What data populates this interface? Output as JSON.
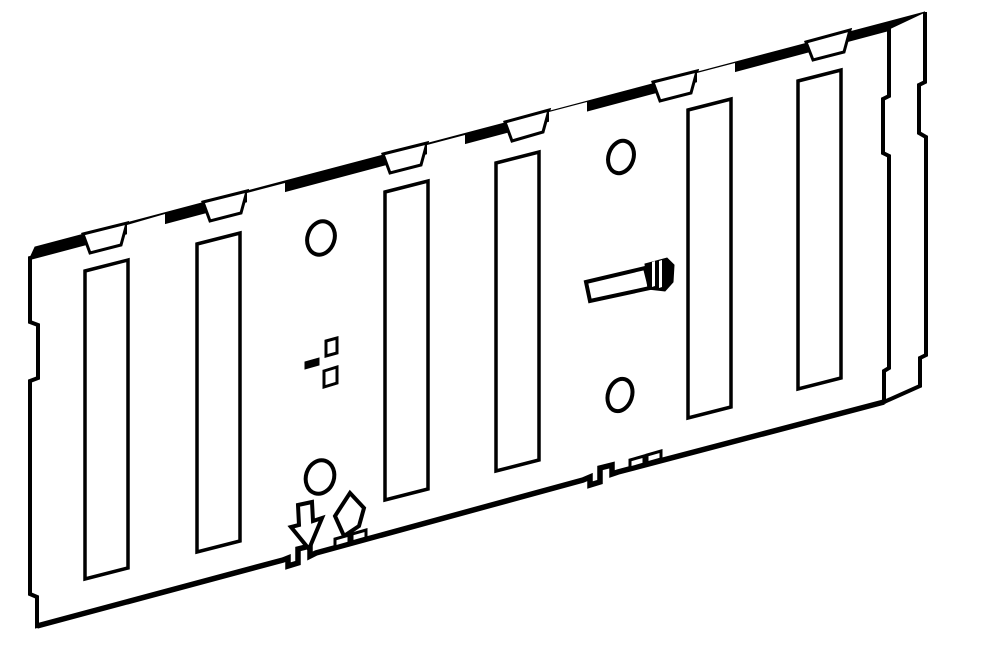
{
  "meta": {
    "title": "Isometric line diagram of a sheet-metal backplane plate with six slots, round holes, bent locating tab, and alignment arrow and diamond marks",
    "background_color": "#ffffff",
    "line_color": "#000000"
  },
  "canvas": {
    "width": 1000,
    "height": 651
  },
  "diagram": {
    "shapes": [
      {
        "name": "plate-front-face",
        "type": "path",
        "fill": "#ffffff",
        "sw": 4,
        "d": "M30,258 L889,29 L889,96 L883,99 L883,153 L889,156 L889,368 L884,371 L884,402 L618,472 L612,474 L612,465 L600,468 L600,482 L590,485 L590,477 L583,480 L316,553 L310,556 L310,546 L298,549 L298,563 L288,566 L288,558 L283,560 L37,626 L37,597 L30,594 L30,381 L38,378 L38,325 L30,322 Z"
      },
      {
        "name": "plate-bottom-edge",
        "type": "polyline",
        "fill": "none",
        "sw": 5.5,
        "points": "884,402 618,472 612,474 612,465 600,468 600,482 590,485 590,477 583,480 316,553 310,556 310,546 298,549 298,563 288,566 288,558 283,560 37,626"
      },
      {
        "name": "top-edge-band",
        "type": "polygon",
        "fill": "#000000",
        "sw": 1,
        "points": "30,258 889,29 925,12 35,247"
      },
      {
        "name": "top-tab-pocket-1",
        "type": "polygon",
        "fill": "#ffffff",
        "sw": 3,
        "points": "83,234 127,223 121,245 90,253"
      },
      {
        "name": "top-tab-pocket-2",
        "type": "polygon",
        "fill": "#ffffff",
        "sw": 3,
        "points": "203,202 247,191 241,213 210,221"
      },
      {
        "name": "top-tab-pocket-3",
        "type": "polygon",
        "fill": "#ffffff",
        "sw": 3,
        "points": "383,154 427,143 421,165 390,173"
      },
      {
        "name": "top-tab-pocket-4",
        "type": "polygon",
        "fill": "#ffffff",
        "sw": 3,
        "points": "505,122 549,110 543,132 512,141"
      },
      {
        "name": "top-tab-pocket-5",
        "type": "polygon",
        "fill": "#ffffff",
        "sw": 3,
        "points": "653,82 697,71 691,93 660,101"
      },
      {
        "name": "top-tab-pocket-6",
        "type": "polygon",
        "fill": "#ffffff",
        "sw": 3,
        "points": "806,42 850,30 844,52 813,60"
      },
      {
        "name": "band-step-slice-1",
        "type": "polygon",
        "fill": "#ffffff",
        "sw": 0,
        "points": "127,225 165,214 165,225 127,235"
      },
      {
        "name": "band-step-slice-2",
        "type": "polygon",
        "fill": "#ffffff",
        "sw": 0,
        "points": "247,193 285,183 285,193 247,203"
      },
      {
        "name": "band-step-slice-3",
        "type": "polygon",
        "fill": "#ffffff",
        "sw": 0,
        "points": "427,145 465,135 465,145 427,155"
      },
      {
        "name": "band-step-slice-4",
        "type": "polygon",
        "fill": "#ffffff",
        "sw": 0,
        "points": "549,112 587,102 587,113 549,123"
      },
      {
        "name": "band-step-slice-5",
        "type": "polygon",
        "fill": "#ffffff",
        "sw": 0,
        "points": "697,73 735,63 735,73 697,83"
      },
      {
        "name": "plate-right-back-edge",
        "type": "polyline",
        "fill": "none",
        "sw": 4,
        "points": "925,12 925,82 919,85 919,133 926,137 926,355 920,358 920,386 884,402"
      },
      {
        "name": "slot-1",
        "type": "polygon",
        "fill": "#ffffff",
        "sw": 3.5,
        "points": "85,271 128,260 128,568 85,579"
      },
      {
        "name": "slot-2",
        "type": "polygon",
        "fill": "#ffffff",
        "sw": 3.5,
        "points": "197,244 240,233 240,541 197,552"
      },
      {
        "name": "slot-3",
        "type": "polygon",
        "fill": "#ffffff",
        "sw": 3.5,
        "points": "385,192 428,181 428,489 385,500"
      },
      {
        "name": "slot-4",
        "type": "polygon",
        "fill": "#ffffff",
        "sw": 3.5,
        "points": "496,163 539,152 539,460 496,471"
      },
      {
        "name": "slot-5",
        "type": "polygon",
        "fill": "#ffffff",
        "sw": 3.5,
        "points": "688,110 731,99 731,407 688,418"
      },
      {
        "name": "slot-6",
        "type": "polygon",
        "fill": "#ffffff",
        "sw": 3.5,
        "points": "798,81 841,70 841,378 798,389"
      },
      {
        "name": "round-hole-top-left",
        "type": "ellipse",
        "fill": "#ffffff",
        "sw": 4,
        "cx": 321,
        "cy": 238,
        "rx": 13.5,
        "ry": 17,
        "rotate": 18
      },
      {
        "name": "round-hole-bottom-left",
        "type": "ellipse",
        "fill": "#ffffff",
        "sw": 4,
        "cx": 320,
        "cy": 477,
        "rx": 14,
        "ry": 17,
        "rotate": 18
      },
      {
        "name": "round-hole-top-right",
        "type": "ellipse",
        "fill": "#ffffff",
        "sw": 4,
        "cx": 621,
        "cy": 157,
        "rx": 12.5,
        "ry": 16.5,
        "rotate": 18
      },
      {
        "name": "round-hole-bottom-right",
        "type": "ellipse",
        "fill": "#ffffff",
        "sw": 4,
        "cx": 620,
        "cy": 395,
        "rx": 12,
        "ry": 16.5,
        "rotate": 18
      },
      {
        "name": "cross-cutout-upper",
        "type": "polygon",
        "fill": "#ffffff",
        "sw": 3,
        "points": "326,341 337,338 337,353 326,356"
      },
      {
        "name": "cross-cutout-lower",
        "type": "polygon",
        "fill": "#ffffff",
        "sw": 3,
        "points": "324,371 337,367 337,383 324,387"
      },
      {
        "name": "cross-cutout-dash",
        "type": "polygon",
        "fill": "#000000",
        "sw": 1,
        "points": "305,362 319,358 319,365 305,369"
      },
      {
        "name": "locating-tab-arm",
        "type": "polygon",
        "fill": "#ffffff",
        "sw": 4,
        "points": "586,282 645,268 650,288 590,301"
      },
      {
        "name": "locating-tab-cap",
        "type": "polygon",
        "fill": "#000000",
        "sw": 1,
        "points": "645,264 667,258 674,265 673,282 665,291 648,289"
      },
      {
        "name": "locating-tab-cap-slit-1",
        "type": "polygon",
        "fill": "#ffffff",
        "sw": 0,
        "points": "652,262 655,261 655,286 652,287"
      },
      {
        "name": "locating-tab-cap-slit-2",
        "type": "polygon",
        "fill": "#ffffff",
        "sw": 0,
        "points": "659,261 662,260 662,287 659,288"
      },
      {
        "name": "locating-tab-cap-notch",
        "type": "polygon",
        "fill": "#ffffff",
        "sw": 0,
        "points": "666,293 674,283 677,293"
      },
      {
        "name": "down-arrow-icon",
        "type": "path",
        "fill": "#ffffff",
        "sw": 4,
        "d": "M298,505 L312,502 L313,521 L322,518 L309,549 L291,527 L299,525 Z"
      },
      {
        "name": "diamond-icon",
        "type": "polygon",
        "fill": "#ffffff",
        "sw": 4,
        "points": "350,493 364,508 359,526 344,536 335,516"
      },
      {
        "name": "edge-tab-left-1",
        "type": "polygon",
        "fill": "#ffffff",
        "sw": 3,
        "points": "335,547 349,543 349,535 335,539"
      },
      {
        "name": "edge-tab-left-2",
        "type": "polygon",
        "fill": "#ffffff",
        "sw": 3,
        "points": "352,542 366,538 366,530 352,534"
      },
      {
        "name": "edge-tab-right-1",
        "type": "polygon",
        "fill": "#ffffff",
        "sw": 3,
        "points": "630,468 644,464 644,456 630,460"
      },
      {
        "name": "edge-tab-right-2",
        "type": "polygon",
        "fill": "#ffffff",
        "sw": 3,
        "points": "647,463 661,459 661,451 647,455"
      }
    ]
  }
}
